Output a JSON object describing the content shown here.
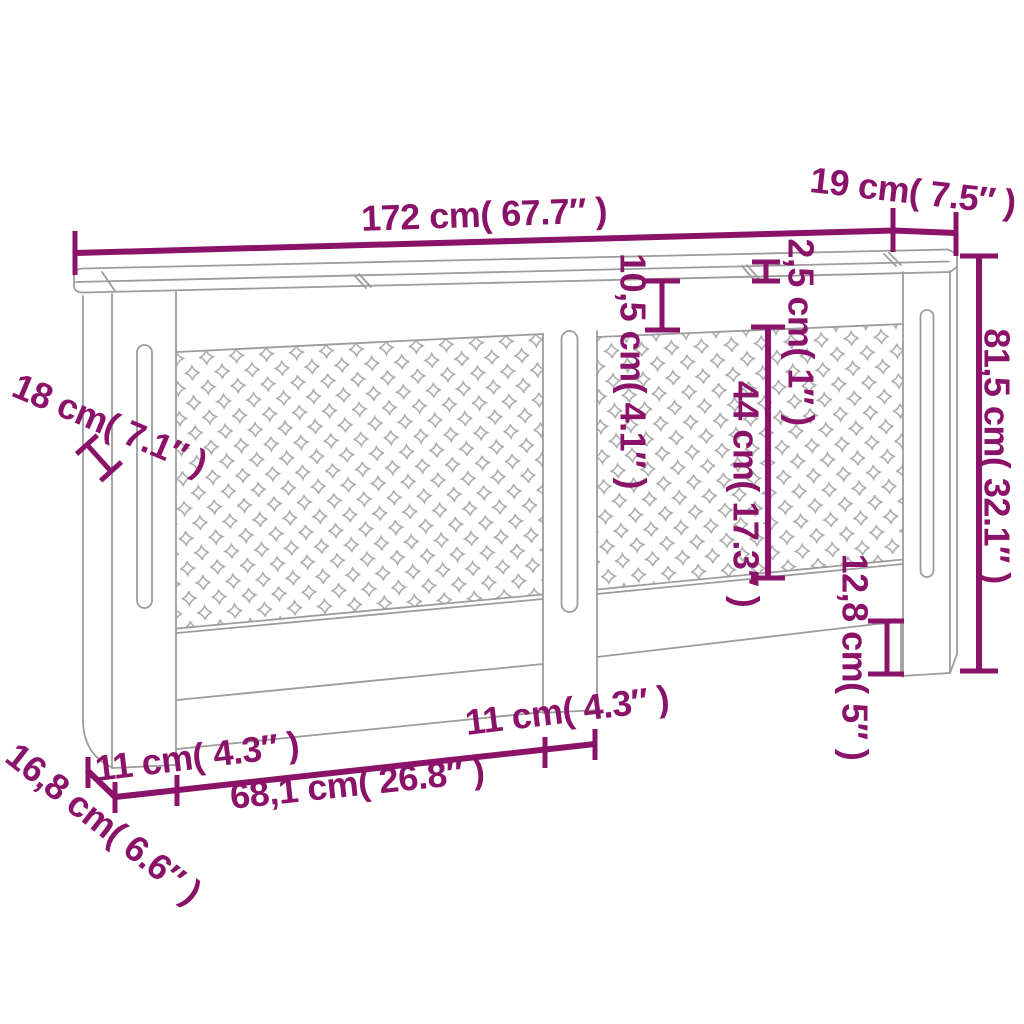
{
  "colors": {
    "dim": "#8a1268",
    "outline": "#9c9c9c",
    "cross": "#ababab",
    "background": "#ffffff"
  },
  "dimensions": {
    "total_width": "172 cm( 67.7″ )",
    "top_depth": "19 cm( 7.5″ )",
    "total_height": "81,5 cm( 32.1″ )",
    "top_thickness": "2,5 cm( 1″ )",
    "top_rail_height": "10,5 cm( 4.1″ )",
    "panel_height": "44 cm( 17.3″ )",
    "foot_height": "12,8 cm( 5″ )",
    "side_depth": "18 cm( 7.1″ )",
    "base_depth": "16,8 cm( 6.6″ )",
    "bottom_left_width": "11 cm( 4.3″ )",
    "bottom_center_width": "68,1 cm( 26.8″ )",
    "bottom_right_width": "11 cm( 4.3″ )"
  }
}
